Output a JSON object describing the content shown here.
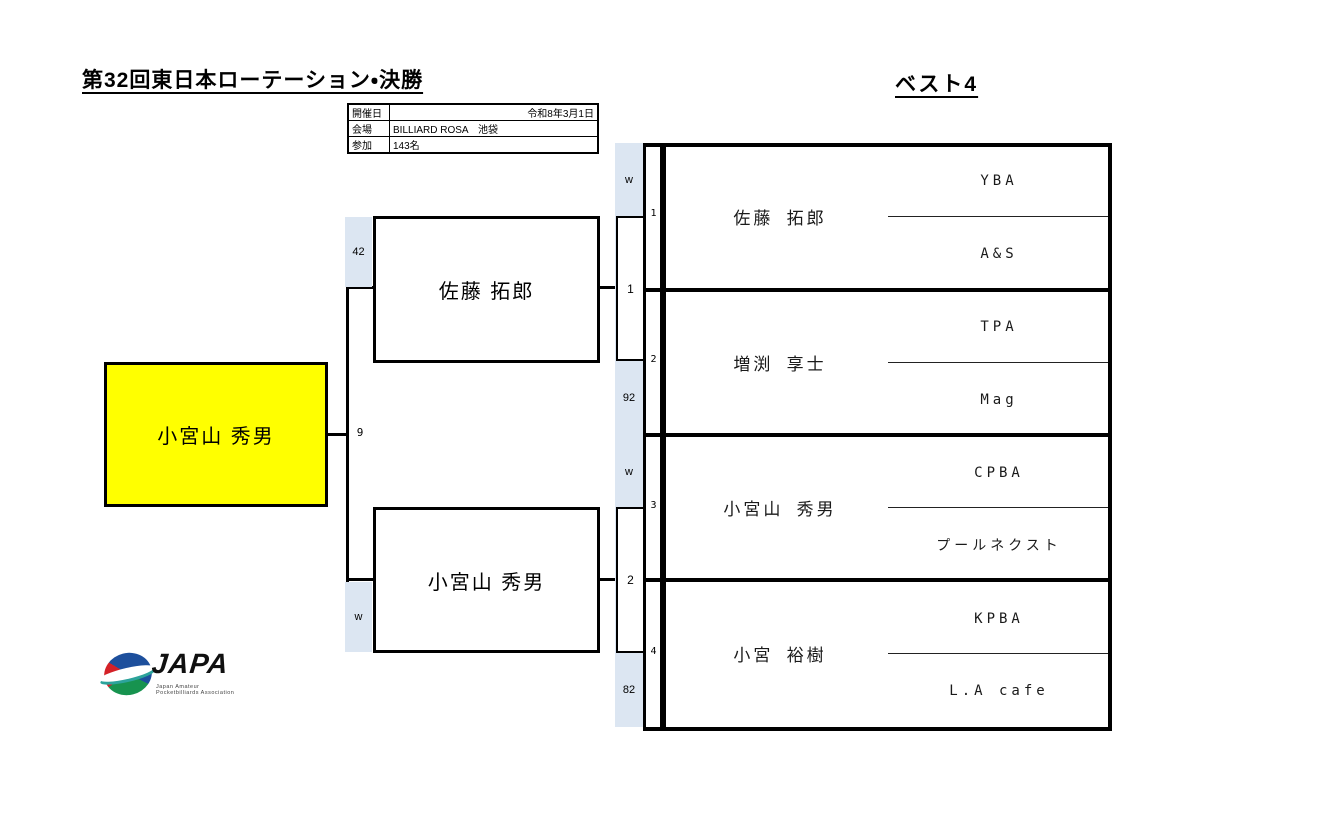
{
  "header": {
    "title": "第32回東日本ローテーション・決勝",
    "best4_label": "ベスト4"
  },
  "info": {
    "rows": [
      {
        "label": "開催日",
        "value": "令和8年3月1日"
      },
      {
        "label": "会場",
        "value": "BILLIARD ROSA　池袋"
      },
      {
        "label": "参加",
        "value": "143名"
      }
    ]
  },
  "bracket": {
    "champion": "小宮山 秀男",
    "final_match_no": "9",
    "finalists": [
      {
        "name": "佐藤 拓郎",
        "final_score": "42"
      },
      {
        "name": "小宮山 秀男",
        "final_score": "w"
      }
    ],
    "matches": [
      {
        "no": "1"
      },
      {
        "no": "2"
      }
    ]
  },
  "players": [
    {
      "seed": "1",
      "name": "佐藤 拓郎",
      "affiliation_top": "YBA",
      "affiliation_bottom": "A&S",
      "semifinal_score": "w"
    },
    {
      "seed": "2",
      "name": "増渕 享士",
      "affiliation_top": "TPA",
      "affiliation_bottom": "Mag",
      "semifinal_score": "92"
    },
    {
      "seed": "3",
      "name": "小宮山 秀男",
      "affiliation_top": "CPBA",
      "affiliation_bottom": "プールネクスト",
      "semifinal_score": "w"
    },
    {
      "seed": "4",
      "name": "小宮 裕樹",
      "affiliation_top": "KPBA",
      "affiliation_bottom": "L.A cafe",
      "semifinal_score": "82"
    }
  ],
  "logo": {
    "word": "JAPA",
    "subtext_line1": "Japan Amateur",
    "subtext_line2": "Pocketbilliards Association"
  },
  "colors": {
    "score_cell_bg": "#dce6f2",
    "champion_bg": "#ffff00",
    "line": "#000000"
  }
}
